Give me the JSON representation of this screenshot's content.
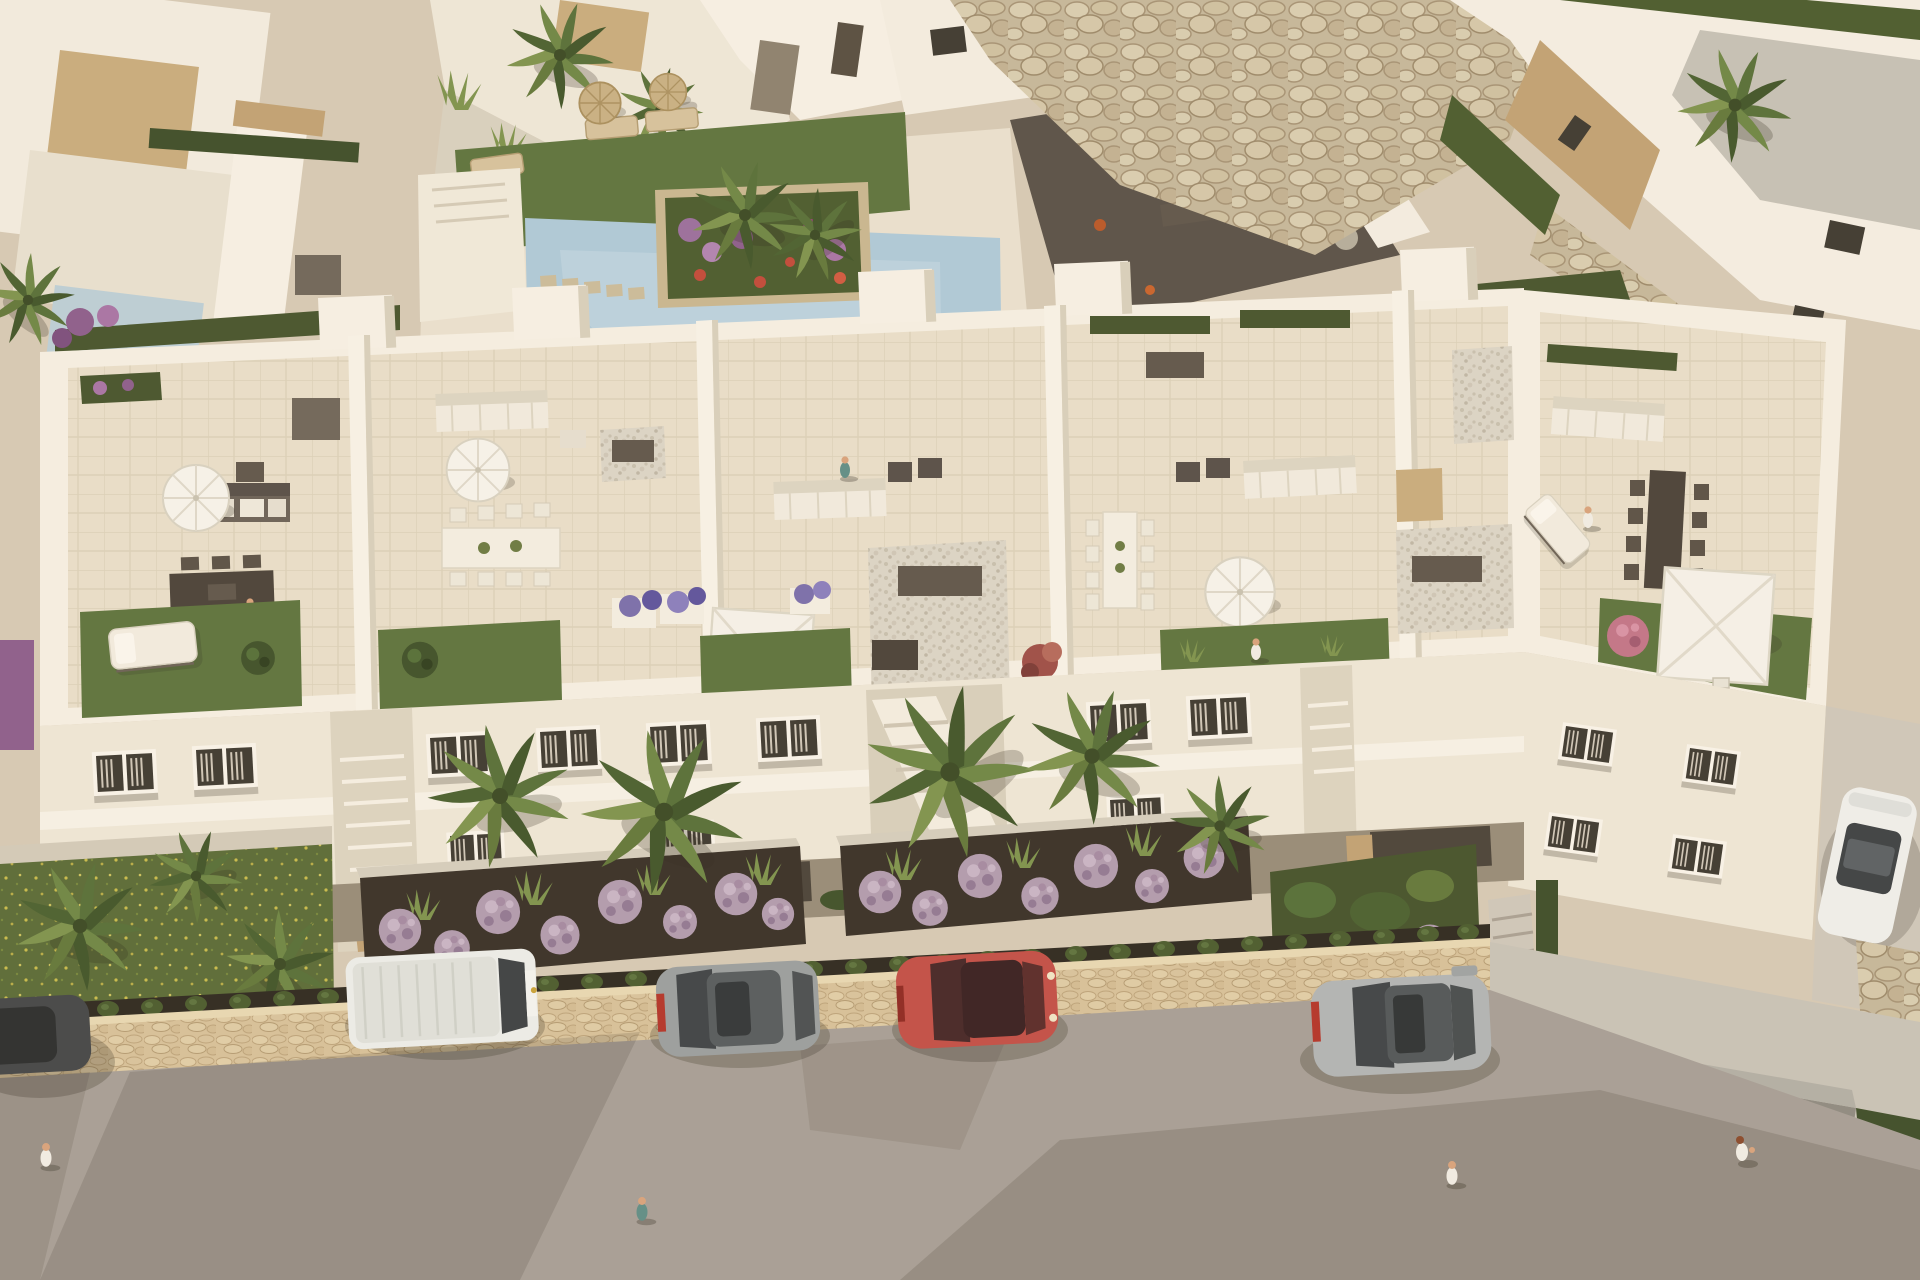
{
  "scene": {
    "type": "aerial-architectural-render",
    "description": "Bird's-eye 3D render of a white Mediterranean apartment complex with rooftop terraces, communal pool, landscaped gardens, stone walls and a street with parked cars",
    "lighting": "warm late-afternoon sun with long soft shadows",
    "view": "oblique top-down"
  },
  "colors": {
    "ground": "#d6cbb8",
    "path_light": "#e0d9c9",
    "roof_white": "#f7f2e8",
    "facade_white": "#efe8da",
    "wall_shade": "#d9d1bf",
    "parapet_white": "#f6f1e6",
    "neighbor_roof_gray": "#c6c2b9",
    "stone_clad": "#c1a377",
    "rock_beige": "#c6b99d",
    "terrace_floor": "#e9e0cd",
    "roof_grass": "#5d7440",
    "front_lawn": "#5a6c39",
    "hedge_green": "#3e4f2c",
    "palm_green": "#57703a",
    "gravel_dark": "#59524a",
    "pebble_light": "#dcd6ca",
    "soil_dark": "#38312a",
    "pool_water": "#aecbdc",
    "pool_deck": "#eae2d2",
    "purple_bush": "#b29cb2",
    "pink_flower": "#c2758b",
    "sidewalk_stone": "#d7c29c",
    "promenade": "#c9c4ba",
    "road": "#a7a099",
    "canopy_gray": "#b3b0a8",
    "umbrella_white": "#f7f5ef",
    "parasol_straw": "#c9b286",
    "furniture_dark": "#554d45",
    "furniture_white": "#f2ede2",
    "van_white": "#edefed",
    "hatchback_gray": "#9aa0a2",
    "car_red": "#c25049",
    "sedan_gray": "#b2b6b8",
    "dark_car": "#44474a",
    "white_car": "#f0f1ef",
    "glass_dark": "#3d4246",
    "skin": "#d9a47f"
  },
  "entities": {
    "buildings": {
      "main_block_modules": 4,
      "right_wing": 1,
      "neighbor_villas": 5,
      "windows_visible": 14,
      "stair_bays": 3
    },
    "amenities": {
      "communal_pool": 1,
      "round_umbrellas": 3,
      "square_canopies": 3,
      "straw_parasols": 2,
      "dining_tables": 5,
      "sofa_groups": 4,
      "sun_loungers": 6,
      "rooftop_lawns": 5
    },
    "vegetation": {
      "palm_trees": 14,
      "purple_ball_bushes": 22,
      "pink_hydrangeas": 6,
      "hedge_rows": 6,
      "planter_flowers": "purple, red and pink mixed beds"
    },
    "vehicles": [
      {
        "name": "dark-car-left-edge",
        "color_key": "dark_car"
      },
      {
        "name": "white-van",
        "color_key": "van_white"
      },
      {
        "name": "gray-hatchback",
        "color_key": "hatchback_gray"
      },
      {
        "name": "red-car",
        "color_key": "car_red"
      },
      {
        "name": "gray-sedan",
        "color_key": "sedan_gray"
      },
      {
        "name": "white-car-driveway",
        "color_key": "white_car"
      }
    ],
    "people": {
      "on_rooftops": 4,
      "on_street": 4
    }
  }
}
